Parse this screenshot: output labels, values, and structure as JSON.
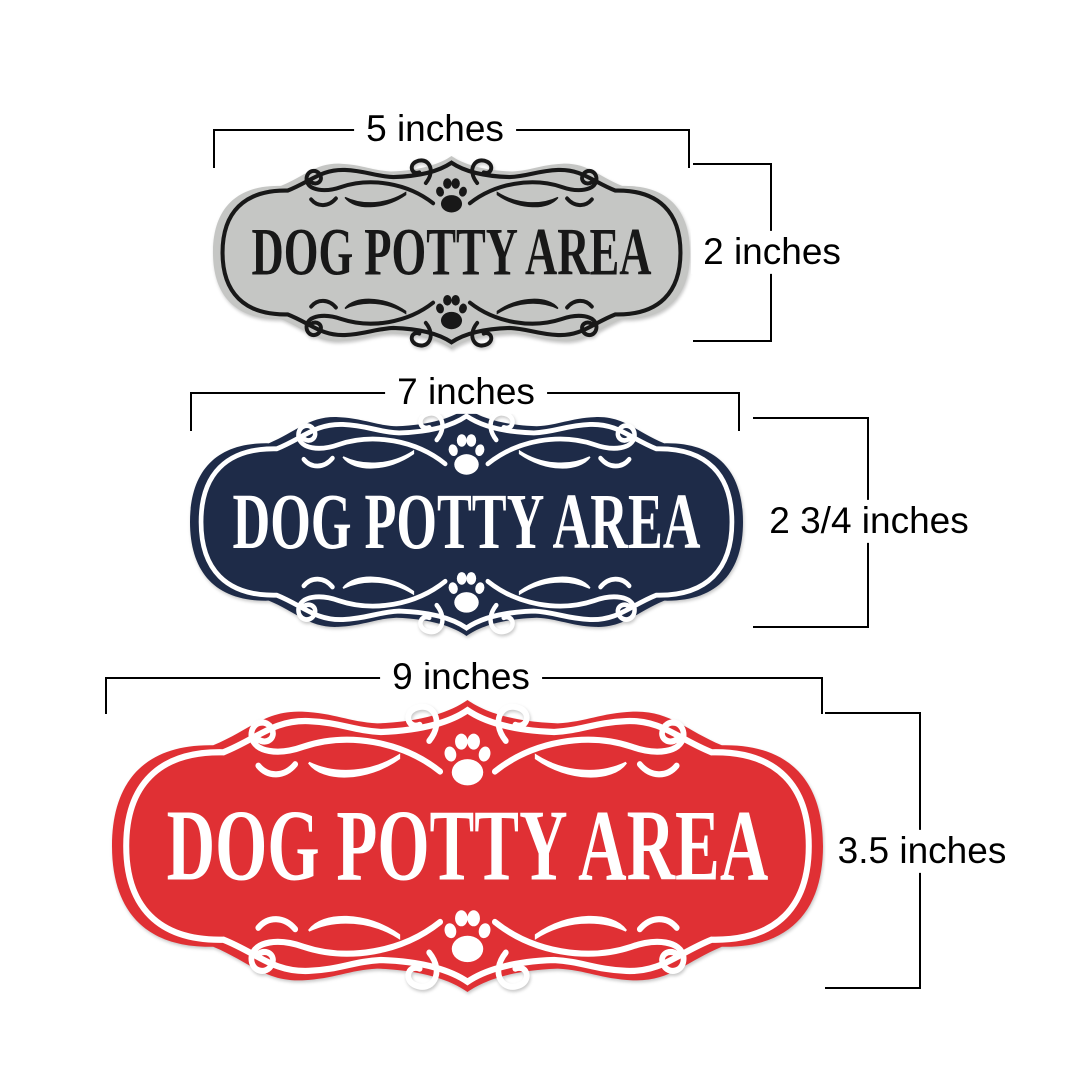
{
  "signs": [
    {
      "id": "small",
      "text": "DOG POTTY AREA",
      "width_label": "5 inches",
      "height_label": "2 inches",
      "fill": "#c5c6c4",
      "accent": "#181818"
    },
    {
      "id": "medium",
      "text": "DOG POTTY AREA",
      "width_label": "7 inches",
      "height_label": "2 3/4 inches",
      "fill": "#1e2b48",
      "accent": "#ffffff"
    },
    {
      "id": "large",
      "text": "DOG POTTY AREA",
      "width_label": "9 inches",
      "height_label": "3.5 inches",
      "fill": "#e03034",
      "accent": "#ffffff"
    }
  ],
  "icons": {
    "paw": "paw-print-icon",
    "flourish": "scroll-flourish-icon"
  },
  "style": {
    "background": "#ffffff",
    "measure_line_color": "#000000",
    "measure_text_color": "#000000"
  }
}
